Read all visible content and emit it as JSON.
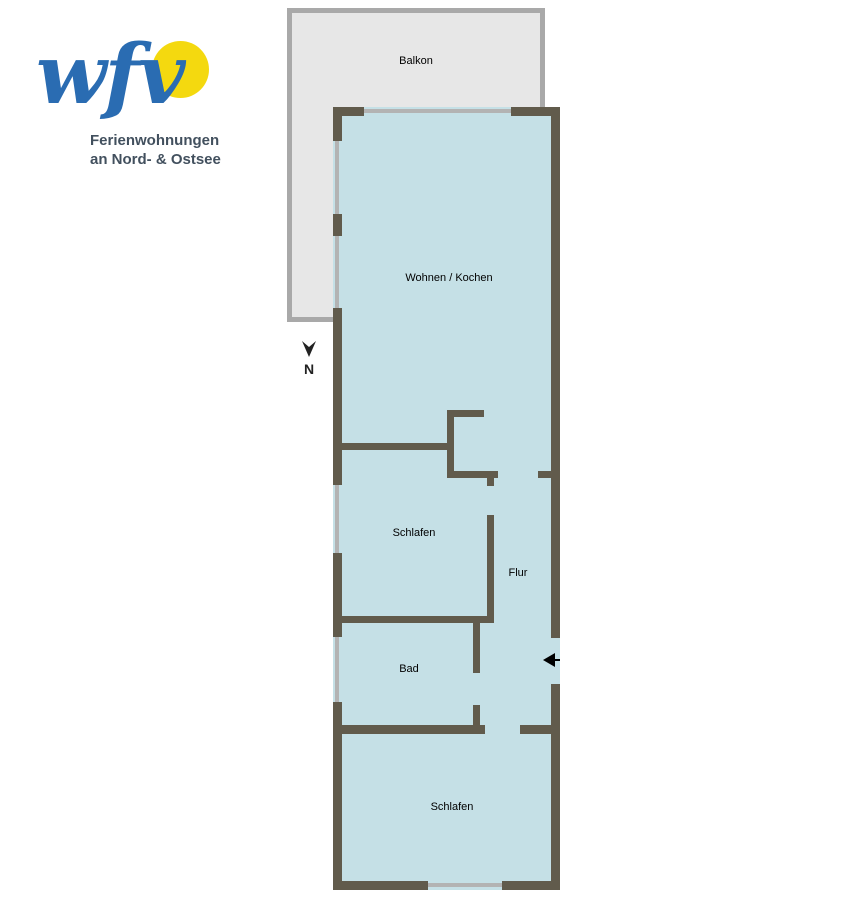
{
  "logo": {
    "wordmark": "wfv",
    "tagline_line1": "Ferienwohnungen",
    "tagline_line2": "an Nord- & Ostsee",
    "colors": {
      "wordmark_blue": "#2a6cb2",
      "sun_yellow": "#f4d90f",
      "tagline_gray": "#42505e"
    }
  },
  "floorplan": {
    "rooms": [
      {
        "id": "balkon",
        "label": "Balkon"
      },
      {
        "id": "wohnen-kochen",
        "label": "Wohnen / Kochen"
      },
      {
        "id": "schlafen-1",
        "label": "Schlafen"
      },
      {
        "id": "flur",
        "label": "Flur"
      },
      {
        "id": "bad",
        "label": "Bad"
      },
      {
        "id": "schlafen-2",
        "label": "Schlafen"
      }
    ],
    "north_label": "N",
    "colors": {
      "wall": "#615b4c",
      "interior_fill": "#c5e0e6",
      "balcony_fill": "#e7e7e7",
      "balcony_border": "#a9a9a9",
      "window_line": "#b3b3b3",
      "entrance_arrow": "#000000"
    }
  }
}
